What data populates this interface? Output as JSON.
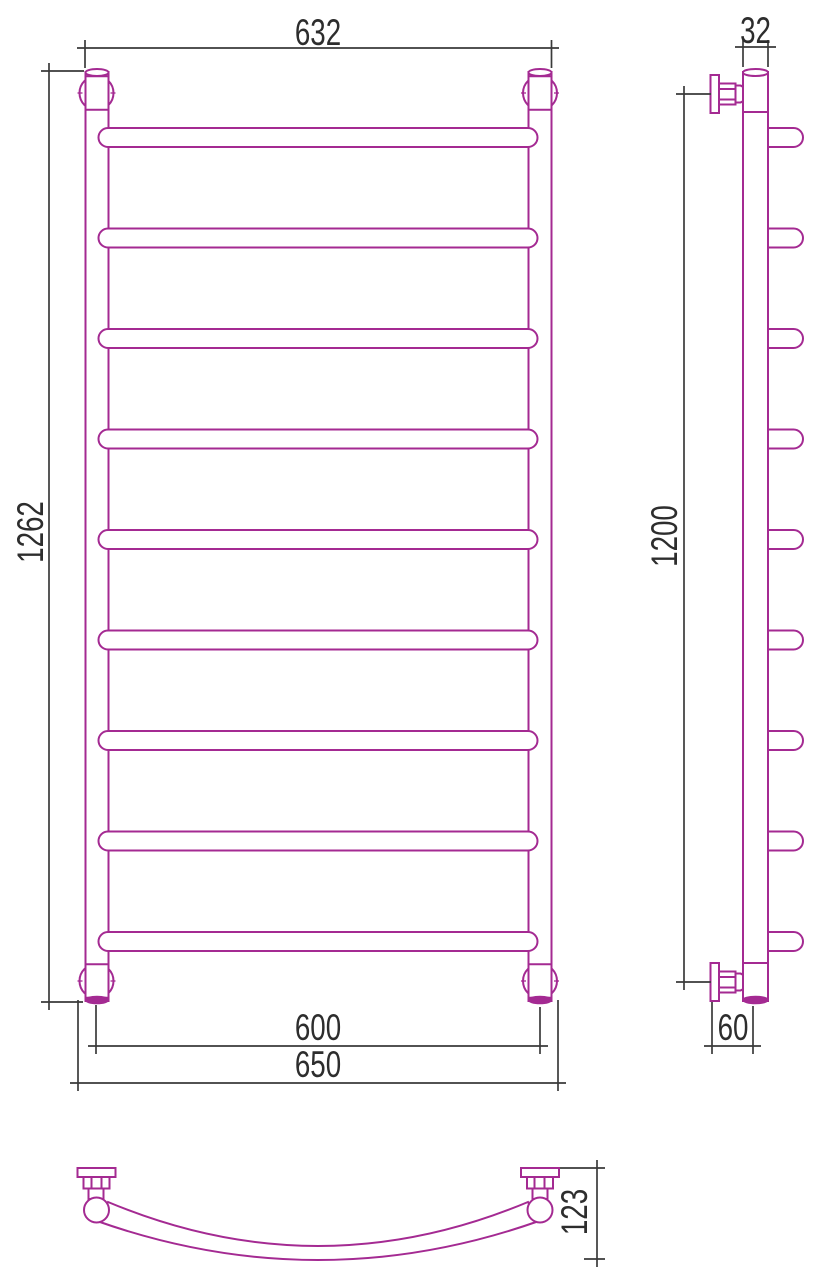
{
  "drawing": {
    "kind": "technical-drawing",
    "subject": "ladder towel radiator with curved rungs, three orthographic views",
    "colors": {
      "product_line": "#A42A92",
      "dimension_line": "#3A3A3A",
      "text": "#2D2D2D",
      "background": "#FFFFFF"
    },
    "views": {
      "front": {
        "label": "front view",
        "rung_count": 9,
        "dims": {
          "top_width": "632",
          "overall_height": "1262",
          "bottom_connection_width": "600",
          "bottom_overall_width": "650"
        }
      },
      "side": {
        "label": "side view",
        "rung_count": 9,
        "dims": {
          "tube_depth": "32",
          "mounting_height": "1200",
          "wall_offset": "60"
        }
      },
      "bottom": {
        "label": "bottom view",
        "dims": {
          "rung_curve_depth": "123"
        }
      }
    }
  }
}
